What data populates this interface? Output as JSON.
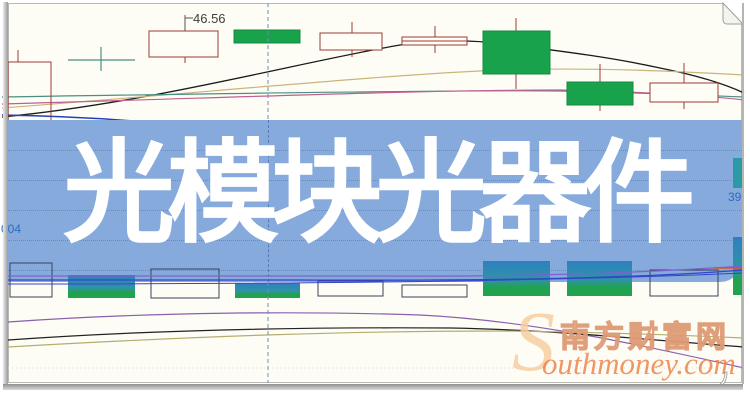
{
  "banner": {
    "title": "光模块光器件",
    "bg_color": "#85aadb",
    "text_color": "#ffffff"
  },
  "chart": {
    "price_label": "46.56",
    "left_axis_label": "004",
    "right_axis_label": "39"
  },
  "watermark": {
    "logo_letter": "S",
    "site_name": "南方财富网",
    "site_url_text": "outhmoney.com",
    "accent_color": "#ef8f55"
  },
  "chart_data": {
    "type": "candlestick",
    "title": "光模块光器件",
    "subtitle_note": "stock K-line chart background, axes unlabeled; only visible numeric annotations are 46.56 (price marker), 004 (left scale fragment), 39 (right scale fragment)",
    "legend": [],
    "grid": "dotted horizontal rows visible through banner",
    "price_annotation": "46.56",
    "price_leader_path": "M185,31 L185,18 L193,18",
    "colors": {
      "candle_outline": "#9a3b34",
      "candle_up_fill": "#fefdf6",
      "candle_down_fill": "#19a24c",
      "candle_down_stroke": "#128a42",
      "doji": "#4a9080",
      "ma_black": "#1a1a1a",
      "ma_tan": "#c9b47c",
      "ma_teal": "#4a9080",
      "ma_magenta": "#c06090",
      "ma_blue": "#2040c0",
      "vol_purple": "#8a5fae",
      "vol_black": "#222222",
      "vol_olive": "#b5ad6e",
      "bar_outline": "#3a4158",
      "bar_grad_top": "#2f7fc0",
      "bar_grad_mid": "#2f94a5",
      "bar_grad_bottom": "#21a24f",
      "teal_bar": "#2b9aa4",
      "banner_line_purple": "#7a63cc",
      "banner_line_blue": "#3347c8",
      "red_tick": "#d4552e",
      "dashed_guide": "#7289b4",
      "gridline_dotted": "#d9d9d0"
    },
    "candles": [
      {
        "x": 8,
        "y": 62,
        "w": 43,
        "h": 63,
        "kind": "hollow-clear"
      },
      {
        "x": 149,
        "y": 31,
        "w": 69,
        "h": 26,
        "kind": "hollow"
      },
      {
        "x": 234,
        "y": 30,
        "w": 66,
        "h": 13,
        "kind": "green"
      },
      {
        "x": 320,
        "y": 33,
        "w": 62,
        "h": 17,
        "kind": "hollow"
      },
      {
        "x": 402,
        "y": 37,
        "w": 65,
        "h": 8,
        "kind": "hollow-split"
      },
      {
        "x": 483,
        "y": 31,
        "w": 67,
        "h": 43,
        "kind": "green"
      },
      {
        "x": 567,
        "y": 82,
        "w": 66,
        "h": 23,
        "kind": "green"
      },
      {
        "x": 650,
        "y": 83,
        "w": 68,
        "h": 19,
        "kind": "hollow"
      }
    ],
    "wicks": [
      [
        18,
        50,
        62
      ],
      [
        18,
        125,
        136
      ],
      [
        185,
        15,
        31
      ],
      [
        185,
        57,
        63
      ],
      [
        352,
        22,
        33
      ],
      [
        352,
        50,
        57
      ],
      [
        435,
        26,
        37
      ],
      [
        435,
        45,
        53
      ],
      [
        516,
        18,
        31
      ],
      [
        516,
        74,
        89
      ],
      [
        600,
        64,
        82
      ],
      [
        600,
        105,
        111
      ],
      [
        684,
        63,
        83
      ],
      [
        684,
        102,
        109
      ]
    ],
    "cross_marks": [
      [
        68,
        60,
        135,
        60
      ],
      [
        101,
        47,
        101,
        71
      ]
    ],
    "ma_lines_upper": [
      {
        "name": "ma-black",
        "color_key": "ma_black",
        "w": 1.3,
        "path": "M2,117 C150,103 300,62 400,45 C440,39 470,40 505,44 C560,51 610,57 660,68 C700,76 725,84 744,93"
      },
      {
        "name": "ma-tan",
        "color_key": "ma_tan",
        "w": 1.2,
        "path": "M2,108 C200,93 380,75 500,70 C600,67 690,72 744,75"
      },
      {
        "name": "ma-teal",
        "color_key": "ma_teal",
        "w": 1.2,
        "path": "M2,97 C250,93 480,90 560,91 C640,93 700,95 744,97"
      },
      {
        "name": "ma-magenta",
        "color_key": "ma_magenta",
        "w": 1.2,
        "path": "M2,104 C250,97 420,90 560,90 C650,92 710,96 744,100"
      },
      {
        "name": "ma-blue",
        "color_key": "ma_blue",
        "w": 1.4,
        "path": "M2,115 C60,116 120,119 180,125"
      }
    ],
    "ma_lines_lower": [
      {
        "name": "vol-purple",
        "color_key": "vol_purple",
        "w": 1.2,
        "path": "M8,322 C150,312 300,311 420,315 C520,320 620,340 744,368"
      },
      {
        "name": "vol-black",
        "color_key": "vol_black",
        "w": 1.2,
        "path": "M8,340 C150,330 300,327 450,328 C560,330 660,341 744,347"
      },
      {
        "name": "vol-olive",
        "color_key": "vol_olive",
        "w": 1.2,
        "path": "M8,347 C200,336 350,331 500,331 C600,332 700,336 744,338"
      }
    ],
    "volume_bars": [
      {
        "x": 10,
        "y": 263,
        "w": 42,
        "h": 34,
        "kind": "outline"
      },
      {
        "x": 68,
        "y": 275,
        "w": 67,
        "h": 23,
        "kind": "grad"
      },
      {
        "x": 151,
        "y": 269,
        "w": 68,
        "h": 29,
        "kind": "outline"
      },
      {
        "x": 235,
        "y": 283,
        "w": 65,
        "h": 15,
        "kind": "grad"
      },
      {
        "x": 318,
        "y": 281,
        "w": 65,
        "h": 15,
        "kind": "outline"
      },
      {
        "x": 402,
        "y": 285,
        "w": 65,
        "h": 12,
        "kind": "outline"
      },
      {
        "x": 483,
        "y": 261,
        "w": 67,
        "h": 35,
        "kind": "grad"
      },
      {
        "x": 567,
        "y": 261,
        "w": 65,
        "h": 35,
        "kind": "grad"
      },
      {
        "x": 650,
        "y": 270,
        "w": 68,
        "h": 26,
        "kind": "outline"
      },
      {
        "x": 733,
        "y": 237,
        "w": 9,
        "h": 58,
        "kind": "grad"
      },
      {
        "x": 733,
        "y": 158,
        "w": 9,
        "h": 30,
        "kind": "teal"
      }
    ],
    "banner_lines": [
      {
        "name": "lower-ma-purple",
        "color_key": "banner_line_purple",
        "w": 1.2,
        "path": "M8,276 L380,276 C520,277 640,273 744,266"
      },
      {
        "name": "lower-ma-blue",
        "color_key": "banner_line_blue",
        "w": 1.3,
        "path": "M8,280 L300,280 C500,281 640,278 744,270"
      },
      {
        "name": "lower-ma-blue2",
        "color_key": "banner_line_blue",
        "w": 1,
        "path": "M8,284 C300,284 560,281 744,273"
      },
      {
        "name": "red-tick",
        "color_key": "red_tick",
        "w": 1.5,
        "path": "M714,268 L744,268"
      }
    ],
    "dashed_vertical": {
      "x": 268,
      "segments": [
        [
          3,
          120
        ],
        [
          282,
          383
        ]
      ]
    },
    "banner_dot_rows": [
      150,
      180,
      210,
      240,
      270
    ],
    "gridline_dotted_y": 368
  }
}
